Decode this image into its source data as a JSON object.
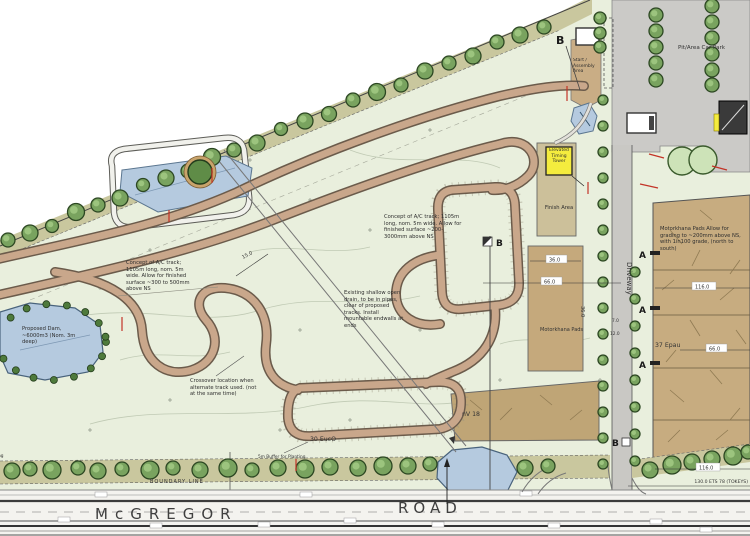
{
  "plan": {
    "areas": {
      "pit_car_park": "Pit/Area Car Park",
      "start_assembly": "Start / Assembly Area",
      "timing_tower": "Elevated Timing Tower",
      "finish_area": "Finish Area",
      "motorkhana_pads": "Motorkhana Pads",
      "nv18": "nV 18",
      "epau": "37 Epau"
    },
    "annotations": {
      "concept_track_left": "Concept of A/C track; 1105m long, nom. 5m wide. Allow for finished surface ~300 to 500mm above NS",
      "concept_track_right": "Concept of A/C track; 1105m long, nom. 5m wide. Allow for finished surface ~200-3000mm above NS",
      "existing_drain": "Existing shallow open drain, to be in pipes, clear of proposed tracks. Install mountable endwalls at ends",
      "proposed_dam": "Proposed Dam, ~6000m3 (Nom. 3m deep)",
      "crossover": "Crossover location when alternate track used. (not at the same time)",
      "motorkhana_grading": "Motorkhana Pads Allow for grading to ~200mm above NS, with 1in100 grade, (north to south)",
      "buffer_planting": "5m Buffer for Planting",
      "euc_count": "30 EucO"
    },
    "roads": {
      "mcgregor": "McGREGOR",
      "road": "ROAD",
      "driveway": "Driveway",
      "boundary": "BOUNDARY LINE"
    },
    "dimensions": {
      "d36": "36.0",
      "d66": "66.0",
      "d116": "116.0",
      "d130": "130.0 ETS 78 (TOKEYS)",
      "d15": "15.0",
      "d7": "7.0",
      "d12": "12.0"
    },
    "markers": {
      "a": "A",
      "b": "B"
    },
    "colors": {
      "water": "#b5cadf",
      "track": "#c9a78b",
      "pad": "#c5a97c",
      "buffer": "#c9c79e",
      "tree": "#79a35f",
      "parking": "#cbcac7",
      "highlight": "#f4ec3e",
      "red": "#c33327"
    }
  }
}
